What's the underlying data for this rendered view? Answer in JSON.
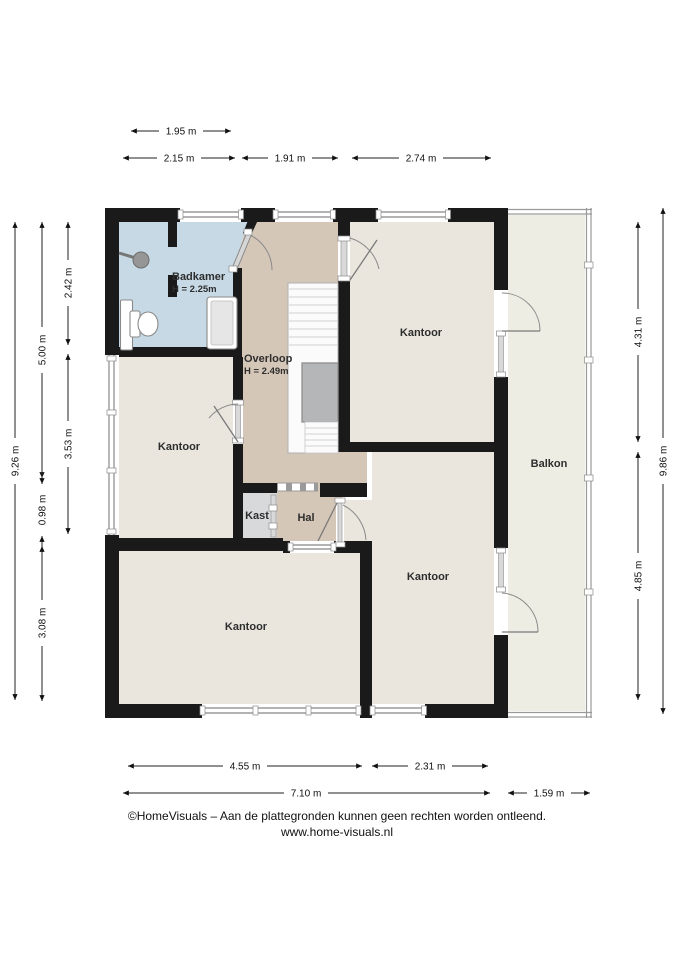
{
  "plan": {
    "rooms": {
      "badkamer": {
        "name": "Badkamer",
        "height": "H = 2.25m"
      },
      "overloop": {
        "name": "Overloop",
        "height": "H = 2.49m"
      },
      "kantoor_top": {
        "name": "Kantoor"
      },
      "kantoor_left": {
        "name": "Kantoor"
      },
      "kantoor_bottom_left": {
        "name": "Kantoor"
      },
      "kantoor_bottom_right": {
        "name": "Kantoor"
      },
      "balkon": {
        "name": "Balkon"
      },
      "kast": {
        "name": "Kast"
      },
      "hal": {
        "name": "Hal"
      }
    },
    "dims": {
      "top": [
        "1.95 m",
        "2.15 m",
        "1.91 m",
        "2.74 m"
      ],
      "left": [
        "9.26 m",
        "5.00 m",
        "2.42 m",
        "3.53 m",
        "0.98 m",
        "3.08 m"
      ],
      "right": [
        "4.31 m",
        "4.85 m",
        "9.86 m"
      ],
      "bottom": [
        "4.55 m",
        "2.31 m",
        "7.10 m",
        "1.59 m"
      ]
    },
    "colors": {
      "wall": "#1a1a1a",
      "badkamer": "#c7d9e5",
      "overloop": "#d5c7b8",
      "hal": "#d5c7b8",
      "kantoor": "#eae6de",
      "balkon": "#eeede3",
      "kast": "#d8d9da",
      "stairs_landing": "#b5b6b7",
      "window": "#9a9a9a"
    }
  },
  "footer": {
    "line1": "©HomeVisuals – Aan de plattegronden kunnen geen rechten worden ontleend.",
    "line2": "www.home-visuals.nl"
  }
}
